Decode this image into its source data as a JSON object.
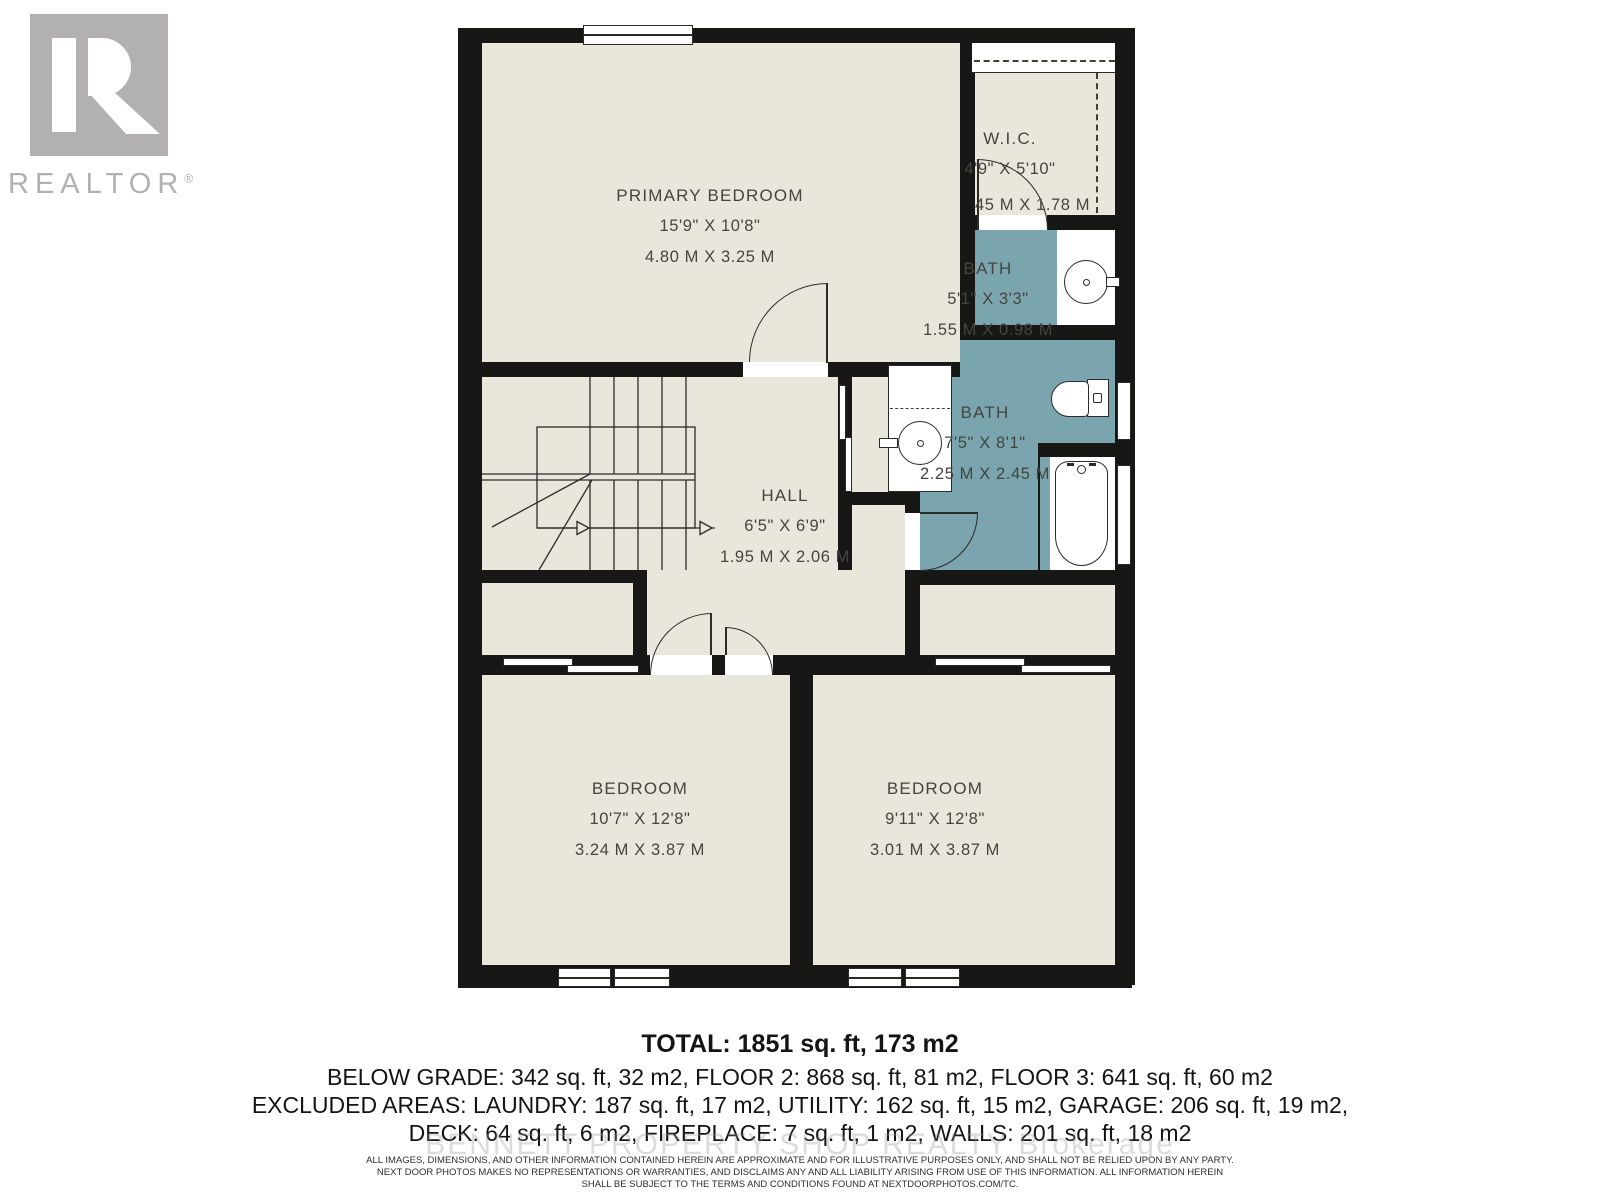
{
  "branding": {
    "logo_letter": "R",
    "logo_word": "REALTOR",
    "registered_mark": "®"
  },
  "rooms": [
    {
      "id": "primary-bedroom",
      "name": "PRIMARY BEDROOM",
      "imperial": "15'9\" X 10'8\"",
      "metric": "4.80 M X 3.25 M"
    },
    {
      "id": "walk-in-closet",
      "name": "W.I.C.",
      "imperial": "4'9\" X 5'10\"",
      "metric": "45 M X 1.78 M"
    },
    {
      "id": "bath-upper",
      "name": "BATH",
      "imperial": "5'1\" X 3'3\"",
      "metric": "1.55 M X 0.98 M"
    },
    {
      "id": "bath-main",
      "name": "BATH",
      "imperial": "7'5\" X 8'1\"",
      "metric": "2.25 M X 2.45 M"
    },
    {
      "id": "hall",
      "name": "HALL",
      "imperial": "6'5\" X 6'9\"",
      "metric": "1.95 M X 2.06 M"
    },
    {
      "id": "bedroom-left",
      "name": "BEDROOM",
      "imperial": "10'7\" X 12'8\"",
      "metric": "3.24 M X 3.87 M"
    },
    {
      "id": "bedroom-right",
      "name": "BEDROOM",
      "imperial": "9'11\" X 12'8\"",
      "metric": "3.01 M X 3.87 M"
    }
  ],
  "summary": {
    "total": "TOTAL: 1851 sq. ft, 173 m2",
    "line2": "BELOW GRADE: 342 sq. ft, 32 m2, FLOOR 2: 868 sq. ft, 81 m2, FLOOR 3: 641 sq. ft, 60 m2",
    "line3": "EXCLUDED AREAS: LAUNDRY: 187 sq. ft, 17 m2, UTILITY: 162 sq. ft, 15 m2, GARAGE: 206 sq. ft, 19 m2,",
    "line4": "DECK: 64 sq. ft, 6 m2, FIREPLACE: 7 sq. ft, 1 m2, WALLS: 201 sq. ft, 18 m2"
  },
  "watermark": "BENNETT PROPERTY SHOP REALTY Brokerage",
  "disclaimer": {
    "line1": "ALL IMAGES, DIMENSIONS, AND OTHER INFORMATION CONTAINED HEREIN ARE APPROXIMATE AND FOR ILLUSTRATIVE PURPOSES ONLY, AND SHALL NOT BE RELIED UPON BY ANY PARTY.",
    "line2": "NEXT DOOR PHOTOS MAKES NO REPRESENTATIONS OR WARRANTIES, AND DISCLAIMS ANY AND ALL LIABILITY ARISING FROM USE OF THIS INFORMATION. ALL INFORMATION HEREIN",
    "line3": "SHALL BE SUBJECT TO THE TERMS AND CONDITIONS FOUND AT NEXTDOORPHOTOS.COM/TC."
  },
  "colors": {
    "wall": "#171715",
    "floor": "#e9e7dc",
    "bath_floor": "#7aa4ae",
    "line": "#2b2b28",
    "logo_gray": "#b2b0b0",
    "label_text": "#45453f"
  }
}
